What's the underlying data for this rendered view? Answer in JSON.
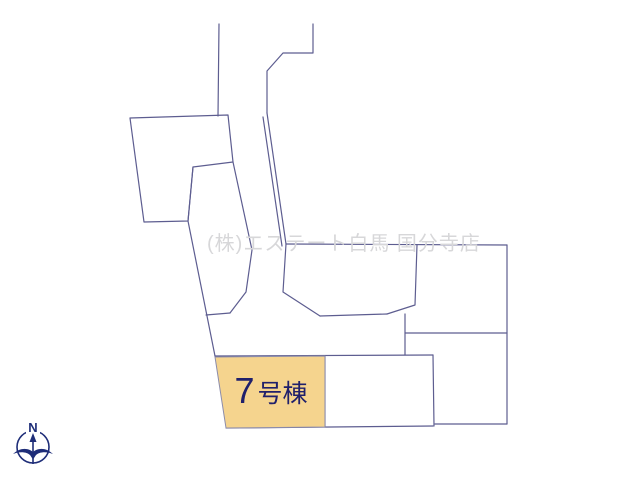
{
  "watermark": {
    "text": "(株)エステート白馬 国分寺店",
    "color": "#d7d7d9"
  },
  "highlighted_lot": {
    "number": "7",
    "suffix": "号棟",
    "full_label": "7号棟",
    "fill_color": "#f5d48e",
    "label_color": "#20206b"
  },
  "compass": {
    "north_label": "N",
    "color": "#1e2d78"
  },
  "map": {
    "line_color": "#5d5d90",
    "background_color": "#ffffff",
    "type_hint": "residential-lot-layout-plan"
  }
}
